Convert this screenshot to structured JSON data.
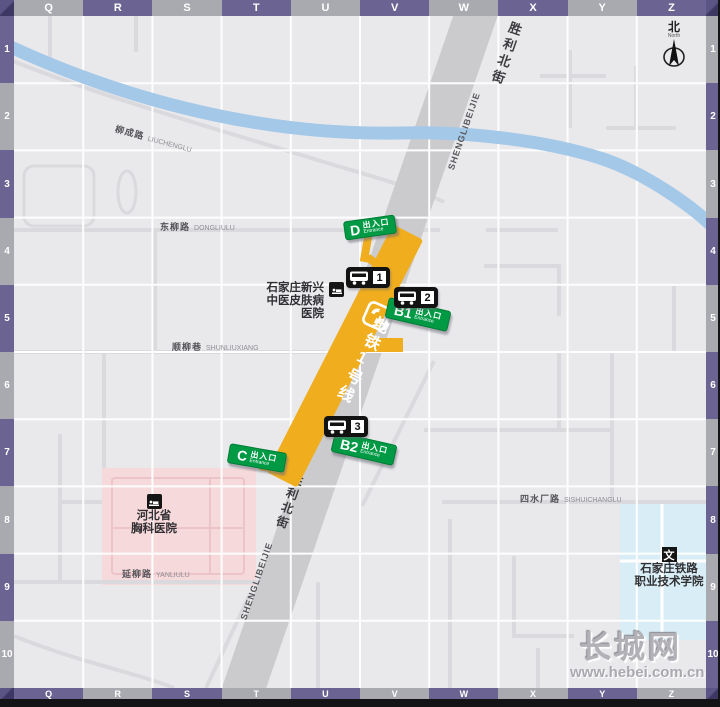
{
  "grid": {
    "top": [
      {
        "label": "Q",
        "tone": "gray"
      },
      {
        "label": "R",
        "tone": "purple"
      },
      {
        "label": "S",
        "tone": "gray"
      },
      {
        "label": "T",
        "tone": "purple"
      },
      {
        "label": "U",
        "tone": "gray"
      },
      {
        "label": "V",
        "tone": "purple"
      },
      {
        "label": "W",
        "tone": "gray"
      },
      {
        "label": "X",
        "tone": "purple"
      },
      {
        "label": "Y",
        "tone": "gray"
      },
      {
        "label": "Z",
        "tone": "purple"
      }
    ],
    "bottom": [
      {
        "label": "Q",
        "tone": "purple"
      },
      {
        "label": "R",
        "tone": "gray"
      },
      {
        "label": "S",
        "tone": "purple"
      },
      {
        "label": "T",
        "tone": "gray"
      },
      {
        "label": "U",
        "tone": "purple"
      },
      {
        "label": "V",
        "tone": "gray"
      },
      {
        "label": "W",
        "tone": "purple"
      },
      {
        "label": "X",
        "tone": "gray"
      },
      {
        "label": "Y",
        "tone": "purple"
      },
      {
        "label": "Z",
        "tone": "gray"
      }
    ],
    "left": [
      {
        "label": "1",
        "tone": "purple"
      },
      {
        "label": "2",
        "tone": "gray"
      },
      {
        "label": "3",
        "tone": "purple"
      },
      {
        "label": "4",
        "tone": "gray"
      },
      {
        "label": "5",
        "tone": "purple"
      },
      {
        "label": "6",
        "tone": "gray"
      },
      {
        "label": "7",
        "tone": "purple"
      },
      {
        "label": "8",
        "tone": "gray"
      },
      {
        "label": "9",
        "tone": "purple"
      },
      {
        "label": "10",
        "tone": "gray"
      }
    ],
    "right": [
      {
        "label": "1",
        "tone": "gray"
      },
      {
        "label": "2",
        "tone": "purple"
      },
      {
        "label": "3",
        "tone": "gray"
      },
      {
        "label": "4",
        "tone": "purple"
      },
      {
        "label": "5",
        "tone": "gray"
      },
      {
        "label": "6",
        "tone": "purple"
      },
      {
        "label": "7",
        "tone": "gray"
      },
      {
        "label": "8",
        "tone": "purple"
      },
      {
        "label": "9",
        "tone": "gray"
      },
      {
        "label": "10",
        "tone": "purple"
      }
    ]
  },
  "roads": {
    "shengli": {
      "cn": "胜利北街",
      "py": "SHENGLIBEIJIE"
    },
    "dongliu": {
      "cn": "东柳路",
      "py": "DONGLIULU"
    },
    "shunliu": {
      "cn": "顺柳巷",
      "py": "SHUNLIUXIANG"
    },
    "yanliu": {
      "cn": "延柳路",
      "py": "YANLIULU"
    },
    "liucheng": {
      "cn": "柳成路",
      "py": "LIUCHENGLU"
    },
    "sishuichang": {
      "cn": "四水厂路",
      "py": "SISHUICHANGLU"
    }
  },
  "metro": {
    "line_label": "地铁1号线",
    "entrances": [
      {
        "id": "D",
        "sub": "出入口",
        "en": "Entrance"
      },
      {
        "id": "B1",
        "sub": "出入口",
        "en": "Entrance"
      },
      {
        "id": "B2",
        "sub": "出入口",
        "en": "Entrance"
      },
      {
        "id": "C",
        "sub": "出入口",
        "en": "Entrance"
      }
    ],
    "bus_stops": [
      "1",
      "2",
      "3"
    ]
  },
  "pois": {
    "xinxing": {
      "lines": [
        "石家庄新兴",
        "中医皮肤病",
        "医院"
      ]
    },
    "xiongke": {
      "lines": [
        "河北省",
        "胸科医院"
      ]
    },
    "tielu": {
      "icon_char": "文",
      "lines": [
        "石家庄铁路",
        "职业技术学院"
      ]
    }
  },
  "north": {
    "cn": "北",
    "en": "North"
  },
  "watermark": {
    "name": "长城网",
    "url": "www.hebei.com.cn"
  },
  "colors": {
    "metro_yellow": "#f0ad1d",
    "entrance_green": "#009a44",
    "frame_purple": "#6b6492",
    "frame_gray": "#a9a9b0",
    "river_blue": "#a4c8e8",
    "road_gray": "#cbcbce",
    "hospital_pink": "#f6d9db",
    "campus_blue": "#d8edf5"
  }
}
